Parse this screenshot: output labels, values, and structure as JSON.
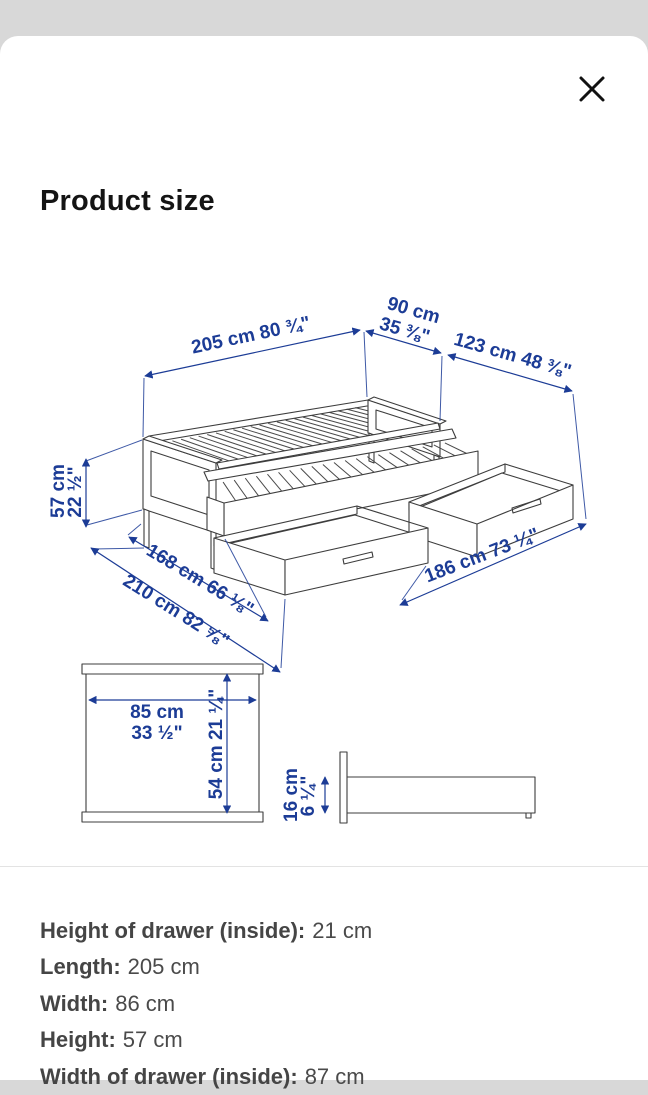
{
  "header": {
    "title": "Product size",
    "close_icon": "✕"
  },
  "diagram": {
    "accent_color": "#1c3c96",
    "line_color": "#3d3d3d",
    "bed": {
      "l205": "205 cm 80 ¾\"",
      "w90_line1": "90 cm",
      "w90_line2": "35 ⅜\"",
      "l123": "123 cm 48 ⅜\"",
      "h57_line1": "57 cm",
      "h57_line2": "22 ½\"",
      "l168": "168 cm 66 ⅛\"",
      "l210": "210 cm 82 ⅝\"",
      "l186": "186 cm 73 ¼\""
    },
    "top_view": {
      "width_line1": "85 cm",
      "width_line2": "33 ½\"",
      "depth": "54 cm 21 ¼\""
    },
    "side_view": {
      "height_line1": "16 cm",
      "height_line2": "6 ¼\""
    }
  },
  "specs": {
    "items": [
      {
        "label": "Height of drawer (inside):",
        "value": "21 cm"
      },
      {
        "label": "Length:",
        "value": "205 cm"
      },
      {
        "label": "Width:",
        "value": "86 cm"
      },
      {
        "label": "Height:",
        "value": "57 cm"
      },
      {
        "label": "Width of drawer (inside):",
        "value": "87 cm"
      }
    ]
  }
}
